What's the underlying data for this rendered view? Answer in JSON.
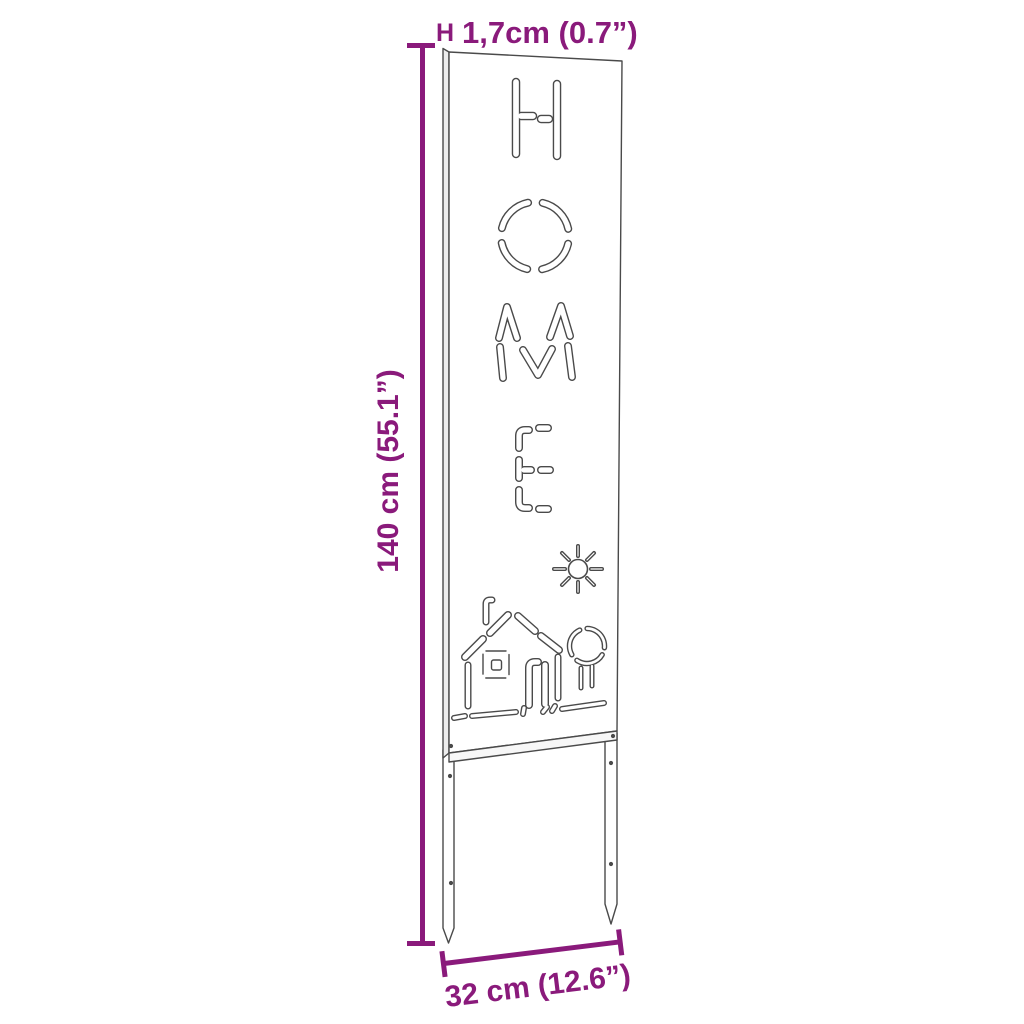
{
  "diagram": {
    "type": "product-dimension-drawing",
    "product": "garden sign panel with two ground stakes",
    "panel": {
      "word": "HOME",
      "letters": [
        "H",
        "O",
        "M",
        "E"
      ],
      "motifs": [
        "sun",
        "house with chimney, window and door",
        "tree",
        "ground"
      ]
    },
    "colors": {
      "dimension_accent": "#8A1A7B",
      "line_art": "#4a4a4a",
      "background": "#ffffff"
    }
  },
  "dimensions": {
    "thickness": {
      "marker": "H",
      "label": "1,7cm (0.7”)"
    },
    "height": {
      "label": "140 cm (55.1”)"
    },
    "width": {
      "label": "32 cm (12.6”)"
    }
  }
}
